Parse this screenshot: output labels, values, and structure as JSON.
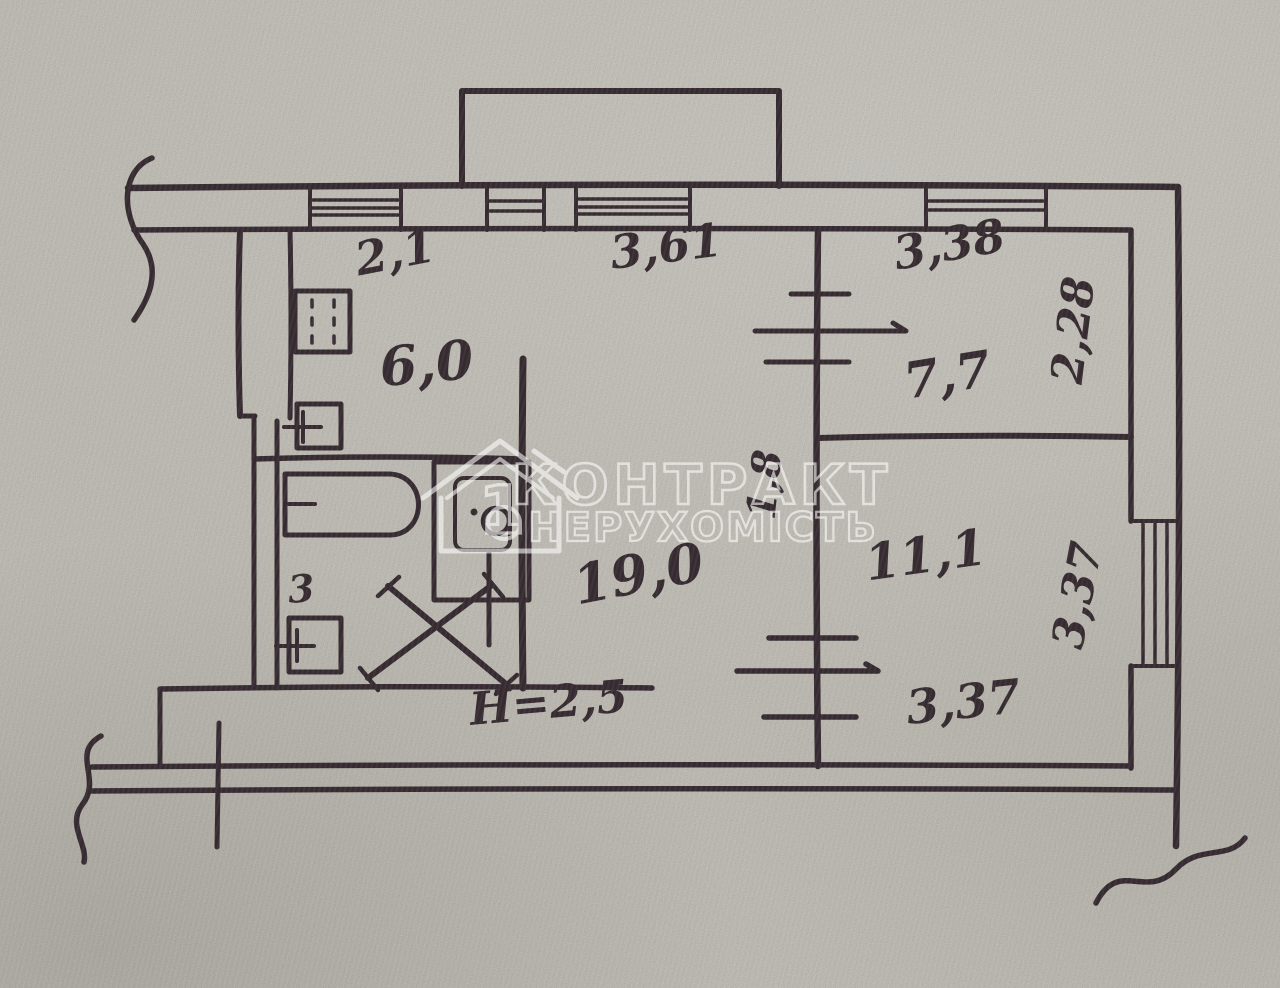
{
  "watermark": {
    "line1": "КОНТРАКТ",
    "line2": "НЕРУХОМІСТЬ",
    "logo_digit": "1"
  },
  "rooms": {
    "kitchen_area": "6,0",
    "living_room_area": "19,0",
    "bedroom1_area": "7,7",
    "bedroom2_area": "11,1",
    "wc_label": "3"
  },
  "dimensions": {
    "kitchen_width": "2,1",
    "living_room_width": "3,61",
    "bedroom1_width": "3,38",
    "bedroom1_depth": "2,28",
    "corridor_width": "1,8",
    "bedroom2_depth": "3,37",
    "bedroom2_width": "3,37",
    "ceiling_height": "H=2,5"
  },
  "colors": {
    "ink": "#362b31",
    "paper": "#d4d1c8",
    "watermark": "#ffffff"
  },
  "icons": [
    "stove-icon",
    "kitchen-sink-icon",
    "bathtub-icon",
    "washing-machine-icon",
    "wc-sink-icon",
    "entrance-door-cross-icon",
    "balcony-outline",
    "window-hatch",
    "wall-break-squiggle",
    "house-logo-icon"
  ]
}
